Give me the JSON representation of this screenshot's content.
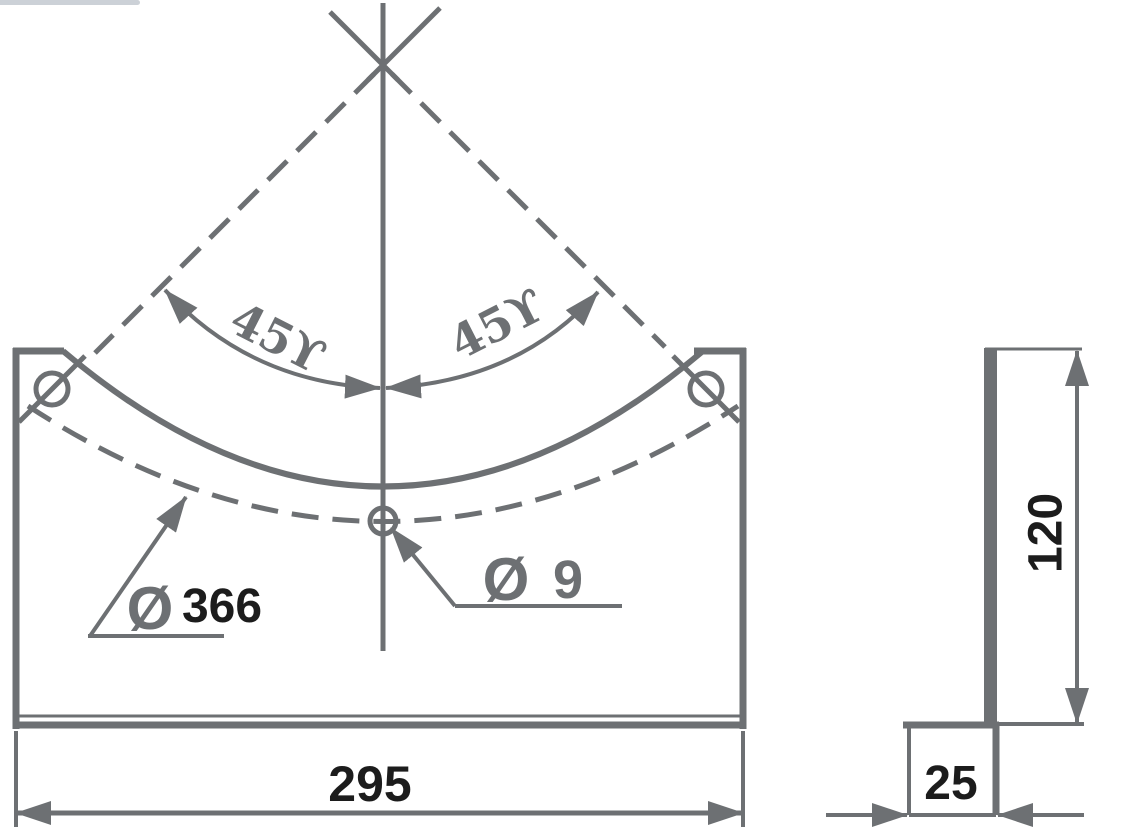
{
  "drawing": {
    "angle_dim_left": "45ϒ",
    "angle_dim_right": "45ϒ",
    "arc_diameter": {
      "symbol": "Ø",
      "value": "366"
    },
    "hole_diameter": {
      "symbol": "Ø",
      "value": "9"
    },
    "overall_width": "295",
    "flange_depth": "25",
    "plate_height": "120"
  },
  "colors": {
    "line_gray": "#6d7073",
    "dim_text_black": "#1c1c1c",
    "artifact_bar": "#ccd1d7",
    "background": "#ffffff"
  }
}
